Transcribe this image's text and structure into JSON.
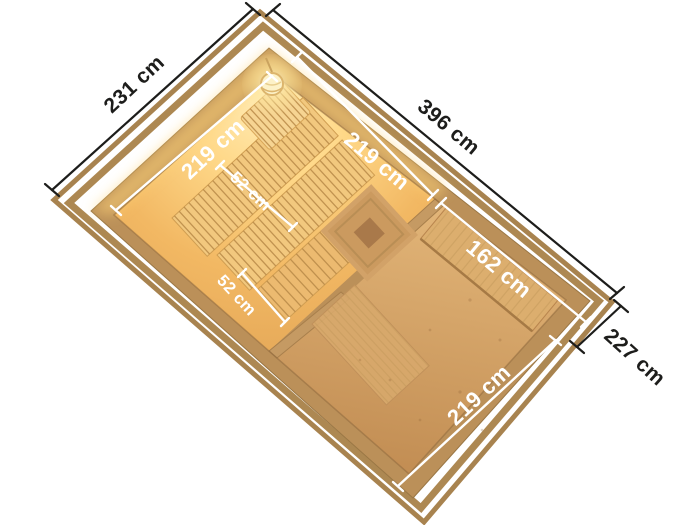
{
  "floorplan": {
    "title": "sauna-house-top-view-floor-plan",
    "exterior_dimensions": {
      "left_side": "231 cm",
      "top_side": "396 cm",
      "right_side": "227 cm"
    },
    "interior_dimensions": {
      "sauna_room_depth": "219 cm",
      "sauna_room_width": "219 cm",
      "bench_upper_depth": "52 cm",
      "bench_lower_depth": "52 cm",
      "main_room_width": "162 cm",
      "main_room_depth": "219 cm"
    },
    "icons": {
      "sauna_lamp": "glowing ceiling lamp",
      "headrest": "slatted head rest",
      "stove_fence": "wooden stove guard"
    },
    "colors": {
      "background": "#ffffff",
      "dimension_text": "#1d1d1b",
      "dimension_line": "#1d1d1b",
      "inner_dimension": "#ffffff",
      "wood_frame": "#a8834f",
      "wood_wall": "#bb9059",
      "bench_wood": "#f2c87e",
      "floor_wood": "#cf9d63",
      "sauna_glow": "#ffd98a"
    }
  }
}
